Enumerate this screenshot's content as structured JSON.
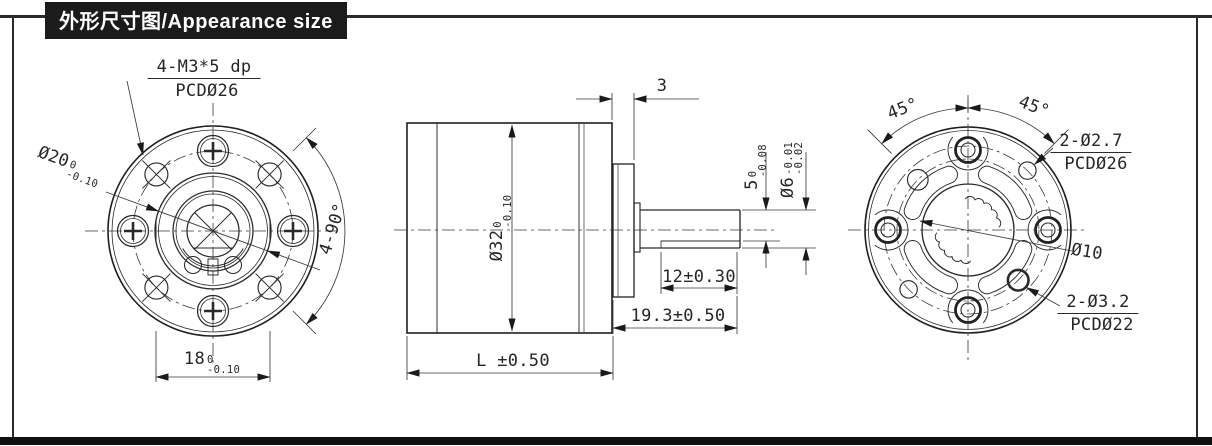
{
  "title": "外形尺寸图/Appearance size",
  "front_view": {
    "thread_callout": "4-M3*5 dp",
    "thread_pcd": "PCDØ26",
    "pilot_dia": {
      "main": "Ø20",
      "sup": "0",
      "sub": "-0.10"
    },
    "angle_dim": "4-90°",
    "flat_width": {
      "main": "18",
      "sup": "0",
      "sub": "-0.10"
    }
  },
  "side_view": {
    "flange_thickness": "3",
    "body_dia": {
      "main": "Ø32",
      "sup": "0",
      "sub": "-0.10"
    },
    "shaft_flat": {
      "main": "5",
      "sup": "0",
      "sub": "-0.08"
    },
    "shaft_dia": {
      "main": "Ø6",
      "sup": "-0.01",
      "sub": "-0.02"
    },
    "flat_length": "12±0.30",
    "shaft_length": "19.3±0.50",
    "body_length": "L ±0.50"
  },
  "rear_view": {
    "angle_left": "45°",
    "angle_right": "45°",
    "hole_small": "2-Ø2.7",
    "hole_small_pcd": "PCDØ26",
    "center_dia": "Ø10",
    "hole_large": "2-Ø3.2",
    "hole_large_pcd": "PCDØ22"
  }
}
